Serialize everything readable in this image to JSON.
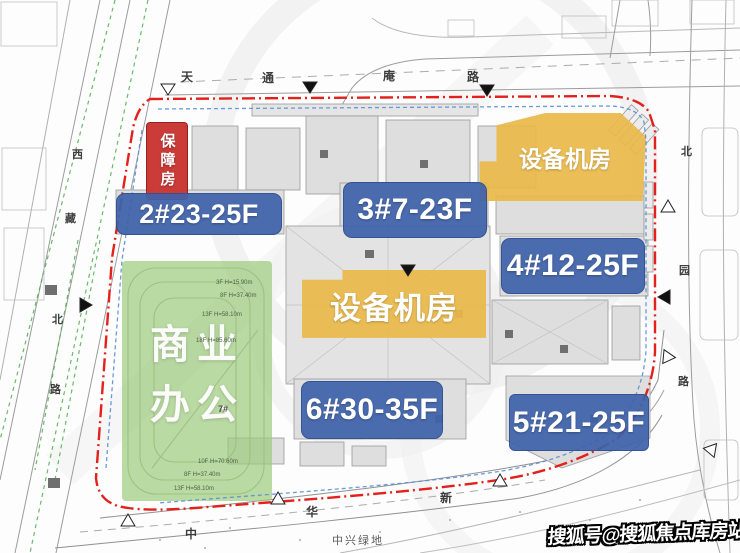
{
  "plan": {
    "buildings": {
      "b2": {
        "label": "2#23-25F"
      },
      "b3": {
        "label": "3#7-23F"
      },
      "b4": {
        "label": "4#12-25F"
      },
      "b5": {
        "label": "5#21-25F"
      },
      "b6": {
        "label": "6#30-35F"
      }
    },
    "zones": {
      "affordable_housing": "保障房",
      "equipment_room_northeast": "设备机房",
      "equipment_room_center": "设备机房",
      "commercial_office_line1": "商业",
      "commercial_office_line2": "办公"
    },
    "streets": {
      "top": [
        "天",
        "通",
        "庵",
        "路"
      ],
      "left": [
        "西",
        "藏",
        "北",
        "路"
      ],
      "right": [
        "北",
        "园",
        "路"
      ],
      "bottom": [
        "中",
        "华",
        "新"
      ],
      "green_space": "中兴绿地"
    },
    "height_annotations": [
      "3F H=15.90m",
      "8F H=37.40m",
      "13F H=58.10m",
      "18F H=85.60m",
      "10F H=70.60m",
      "8F H=37.40m",
      "13F H=58.10m"
    ],
    "small_labels": {
      "b7": "7#"
    }
  },
  "watermark": "搜狐号@搜狐焦点库房站",
  "colors": {
    "boundary_red": "#e3211c",
    "label_blue": "#3e62aa",
    "label_red": "#c8312d",
    "label_yellow": "#e9b849",
    "zone_green": "#9dc97c",
    "utility_blue": "#5b8fd6",
    "tree_green": "#4fae4f"
  }
}
